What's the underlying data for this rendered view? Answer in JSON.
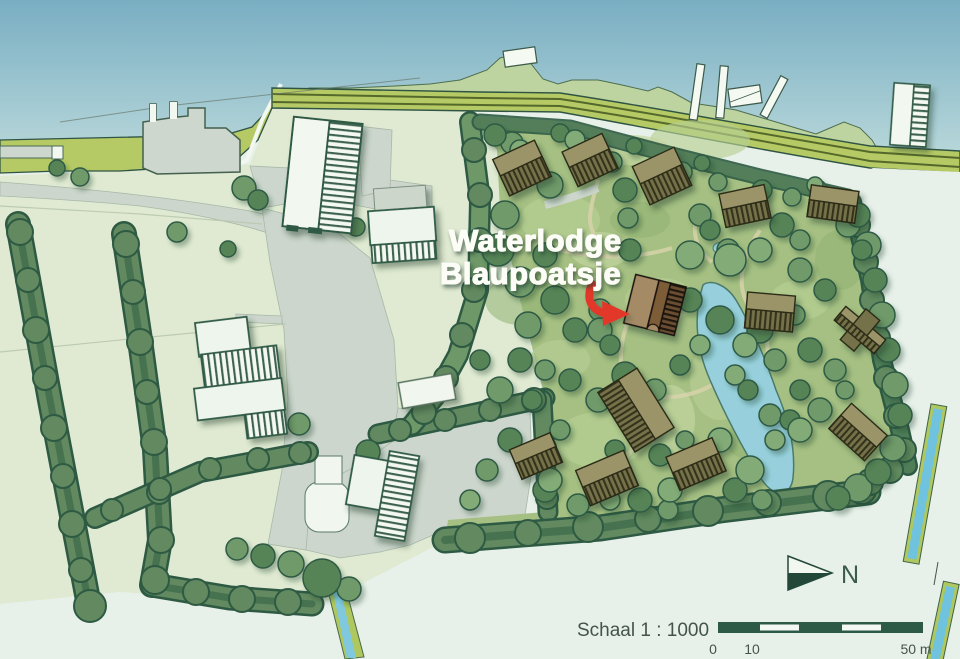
{
  "map": {
    "title_line1": "Waterlodge",
    "title_line2": "Blaupoatsje",
    "north_label": "N",
    "scale": {
      "label": "Schaal 1 : 1000",
      "tick_0": "0",
      "tick_10": "10",
      "tick_50": "50 m"
    },
    "colors": {
      "water": "#7fb2c4",
      "water_light": "#b2d4d8",
      "dike": "#b5ca64",
      "field": "#e0ead2",
      "mint": "#e7f0e9",
      "park": "#a6c083",
      "hedge": "#5d8760",
      "hedge_dark": "#2e5a44",
      "road": "#ccd6cc",
      "building_white": "#f2f7f0",
      "lodge_olive": "#9a9468",
      "lodge_hatch": "#6f6c45",
      "highlight_tan": "#a58a66",
      "highlight_brown": "#7d5c39",
      "pond": "#97d0dc",
      "canal": "#7fc8de",
      "arrow_red": "#e2392a",
      "text": "#44544c",
      "title": "#fcfdf6"
    }
  }
}
